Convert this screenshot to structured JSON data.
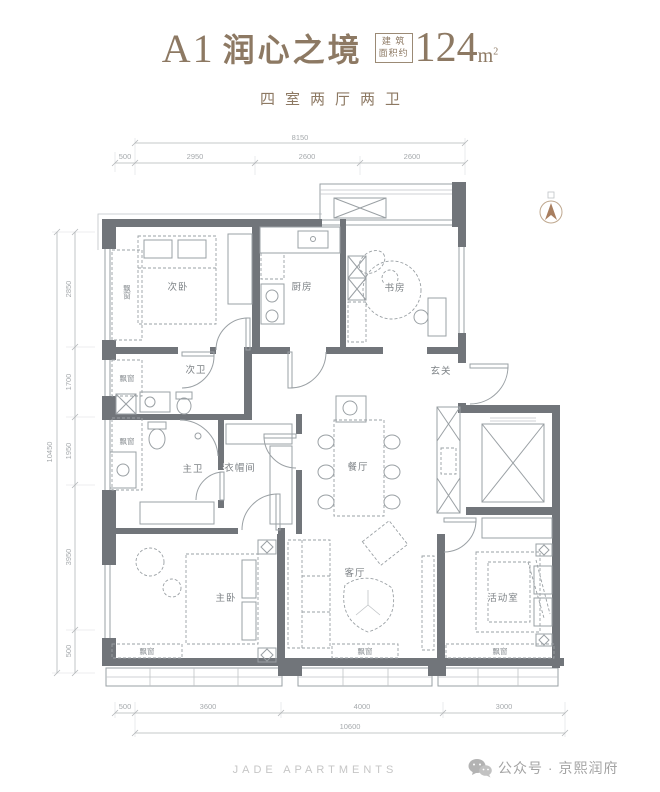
{
  "header": {
    "unit": "A1",
    "name": "润心之境",
    "area_box": [
      "建 筑",
      "面积约"
    ],
    "area_value": "124",
    "area_unit": "m",
    "area_unit_sup": "2",
    "subtitle": "四室两厅两卫"
  },
  "plan": {
    "rooms": {
      "second_bedroom": "次卧",
      "kitchen": "厨房",
      "study": "书房",
      "foyer": "玄关",
      "second_bath": "次卫",
      "master_bath": "主卫",
      "closet": "衣帽间",
      "dining": "餐厅",
      "master_bedroom": "主卧",
      "living": "客厅",
      "activity": "活动室"
    },
    "bay_window": "飘窗",
    "dimensions": {
      "top": {
        "overall": "8150",
        "segments": [
          "500",
          "2950",
          "2600",
          "2600"
        ]
      },
      "left": {
        "overall": "10450",
        "segments": [
          "2850",
          "1700",
          "1950",
          "3950",
          "500"
        ]
      },
      "bottom": {
        "overall": "10600",
        "segments": [
          "500",
          "3600",
          "4000",
          "3000"
        ]
      }
    }
  },
  "footer": {
    "brand": "JADE APARTMENTS",
    "wechat": "公众号 · 京熙润府"
  },
  "colors": {
    "accent": "#8d7963",
    "wall": "#71757a"
  }
}
